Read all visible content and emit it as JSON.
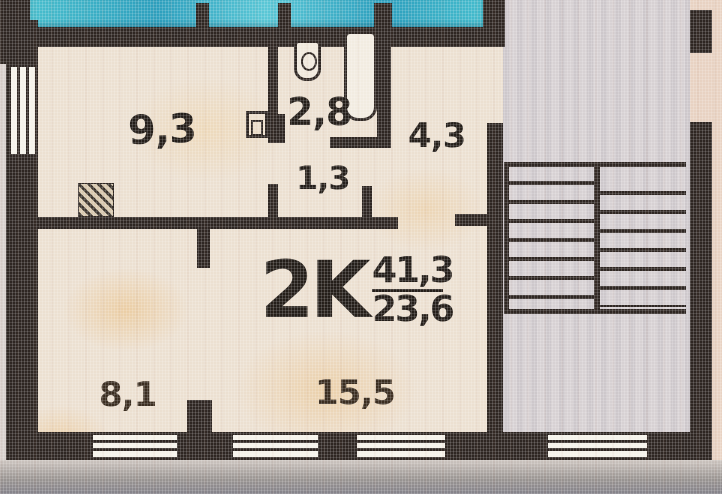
{
  "floor_plan": {
    "unit": {
      "label": "2K",
      "total_area": "41,3",
      "living_area": "23,6"
    },
    "rooms": [
      {
        "name": "kitchen-room",
        "area": "9,3"
      },
      {
        "name": "bathroom",
        "area": "2,8"
      },
      {
        "name": "hallway",
        "area": "4,3"
      },
      {
        "name": "corridor",
        "area": "1,3"
      },
      {
        "name": "bedroom",
        "area": "8,1"
      },
      {
        "name": "living-room",
        "area": "15,5"
      }
    ],
    "fixtures": {
      "toilet": "toilet-icon",
      "bathtub": "bathtub-icon",
      "sink": "sink-icon",
      "vent_shaft": "vent-shaft-icon",
      "staircase": "staircase-icon"
    },
    "colors": {
      "wall": "#2e2622",
      "paper": "#ece0d1",
      "stairwell": "#d7d1d3",
      "blue_band": "#2fa8c2",
      "exterior": "#e8d2c2",
      "text": "#241e19"
    }
  }
}
